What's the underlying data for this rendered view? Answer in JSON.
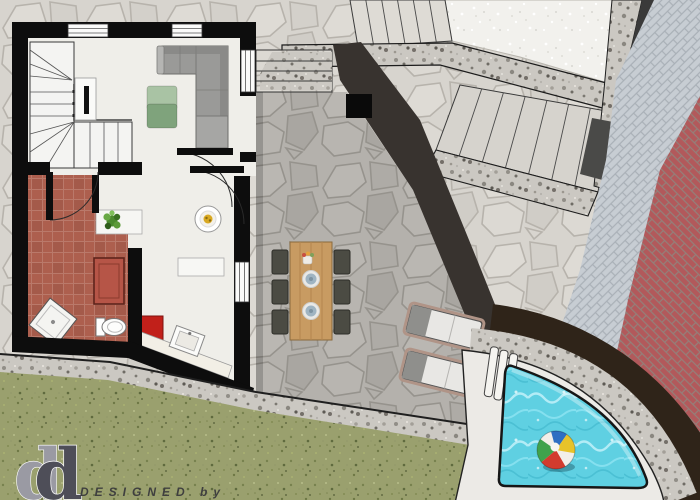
{
  "branding": {
    "credit_line": "DESIGNED by",
    "logo_letter_back": "d",
    "logo_letter_front": "d"
  },
  "palette": {
    "flag_light": "#d7d4ce",
    "flag_dark": "#b4b1ac",
    "granite": "#cbc8c2",
    "white_terrace": "#f2f1ed",
    "herringbone_pale": "#c7cdd3",
    "brick_red": "#b2595b",
    "lawn": "#9aa06e",
    "pool_water": "#5fd0e2",
    "pool_dark_band": "#2f2419",
    "terracotta_floor": "#ad5f4e",
    "living_floor": "#efeee9",
    "wall": "#0d0d0d",
    "sofa": "#9a9a98",
    "coffee_table_green": "#7fa37c",
    "coffee_table_green_light": "#a9c3a4",
    "accent_red": "#c1201a",
    "wood_table": "#c89b62",
    "chair": "#4b4b43",
    "lounger_body": "#e8e7e4",
    "lounger_head": "#8f8f8c"
  },
  "plan": {
    "rooms": [
      "living-room",
      "stair-hall",
      "bathroom-terracotta",
      "kitchen-dining"
    ],
    "outdoor": [
      "flagstone-patio",
      "stone-steps",
      "upper-terrace",
      "outdoor-staircase",
      "herringbone-path",
      "brick-paving",
      "lawn",
      "pool-deck",
      "pool"
    ],
    "furniture": [
      "indoor-staircase",
      "corner-sofa",
      "coffee-table",
      "tv-unit",
      "plant-counter",
      "round-table",
      "shower-tray",
      "toilet",
      "kitchen-sink",
      "red-cabinet",
      "red-bench",
      "dining-table",
      "dining-chairs",
      "sun-loungers",
      "pool-bench",
      "beach-ball"
    ]
  }
}
